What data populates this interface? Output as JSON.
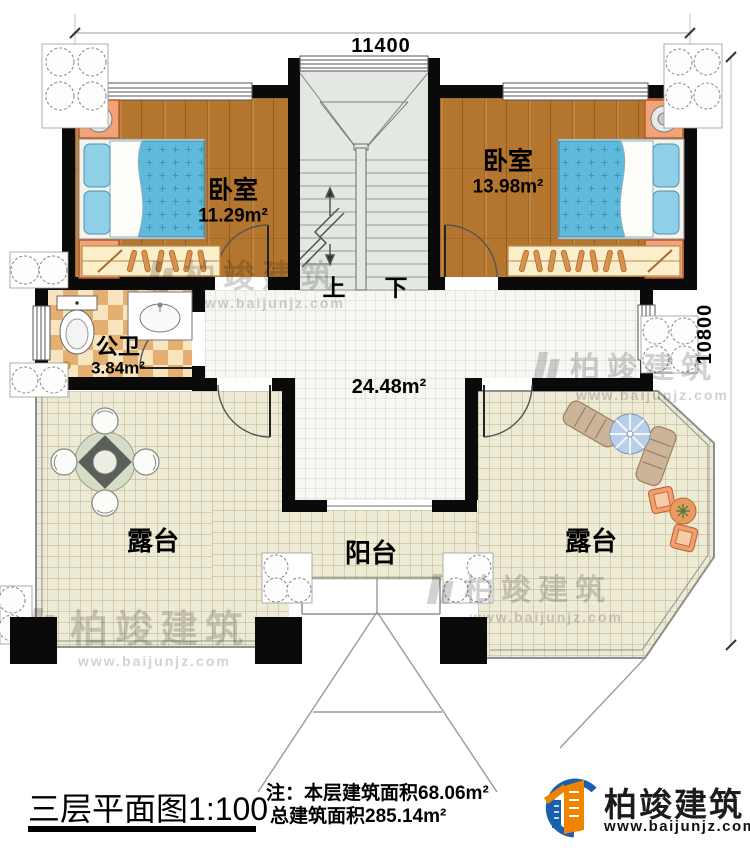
{
  "dimensions": {
    "top": "11400",
    "right": "10800"
  },
  "rooms": {
    "bedroom_left": {
      "name": "卧室",
      "area": "11.29m²"
    },
    "bedroom_right": {
      "name": "卧室",
      "area": "13.98m²"
    },
    "bathroom": {
      "name": "公卫",
      "area": "3.84m²"
    },
    "hall": {
      "area": "24.48m²"
    },
    "terrace_left": {
      "name": "露台"
    },
    "terrace_right": {
      "name": "露台"
    },
    "balcony": {
      "name": "阳台"
    }
  },
  "stairs": {
    "up": "上",
    "down": "下"
  },
  "footer": {
    "title": "三层平面图",
    "scale": "1:100",
    "note_prefix": "注：",
    "note_line1": "本层建筑面积68.06m²",
    "note_line2": "总建筑面积285.14m²",
    "brand": "柏竣建筑",
    "website": "www.baijunjz.com"
  },
  "watermark": {
    "brand": "柏竣建筑",
    "website": "www.baijunjz.com"
  },
  "colors": {
    "wall": "#0a0a0a",
    "wood_floor": "#b4762e",
    "tile_cream": "#eeebd5",
    "tile_white": "#f6f6f3",
    "checker_dark": "#e5af72",
    "stairs": "#e3e9e2",
    "bed_blue": "#5fb9da",
    "pillow_blue": "#8fd0e8",
    "furniture_orange": "#f0a477",
    "wardrobe_tan": "#faeecb",
    "umbrella_blue": "#b9cfe9",
    "logo_blue": "#1a5fae",
    "logo_orange": "#f08300",
    "watermark_gray": "#c7c7c7",
    "line_gray": "#8f8f8f"
  }
}
